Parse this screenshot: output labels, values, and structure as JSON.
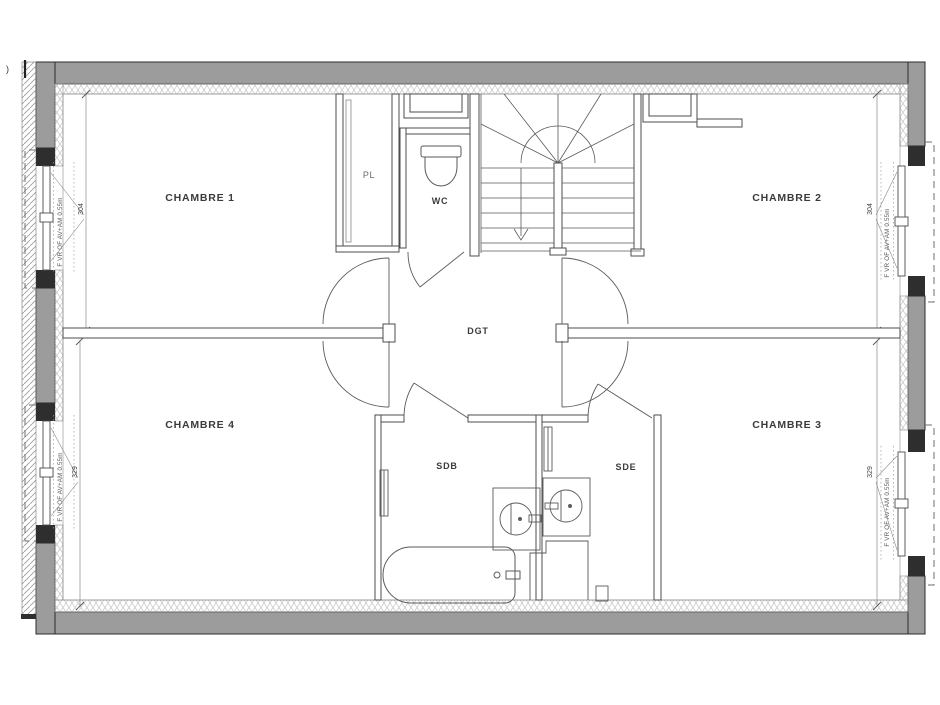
{
  "plan": {
    "rooms": [
      {
        "id": "chambre1",
        "label": "CHAMBRE 1"
      },
      {
        "id": "chambre2",
        "label": "CHAMBRE 2"
      },
      {
        "id": "chambre3",
        "label": "CHAMBRE 3"
      },
      {
        "id": "chambre4",
        "label": "CHAMBRE 4"
      },
      {
        "id": "pl",
        "label": "PL"
      },
      {
        "id": "wc",
        "label": "WC"
      },
      {
        "id": "dgt",
        "label": "DGT"
      },
      {
        "id": "sdb",
        "label": "SDB"
      },
      {
        "id": "sde",
        "label": "SDE"
      }
    ],
    "windows": [
      {
        "id": "left-top",
        "dimension": "304",
        "spec": "F VR OF AV+AM 0.55m"
      },
      {
        "id": "left-bottom",
        "dimension": "329",
        "spec": "F VR OF AV+AM 0.55m"
      },
      {
        "id": "right-top",
        "dimension": "304",
        "spec": "F VR OF AV+AM 0.55m"
      },
      {
        "id": "right-bottom",
        "dimension": "329",
        "spec": "F VR OF AV+AM 0.55m"
      }
    ],
    "margin_mark": ")",
    "colors": {
      "wall_gray": "#9c9c9c",
      "pier_dark": "#2e2e2e",
      "wall_line": "#4d4d4d",
      "label_text": "#3b3b3b"
    }
  }
}
